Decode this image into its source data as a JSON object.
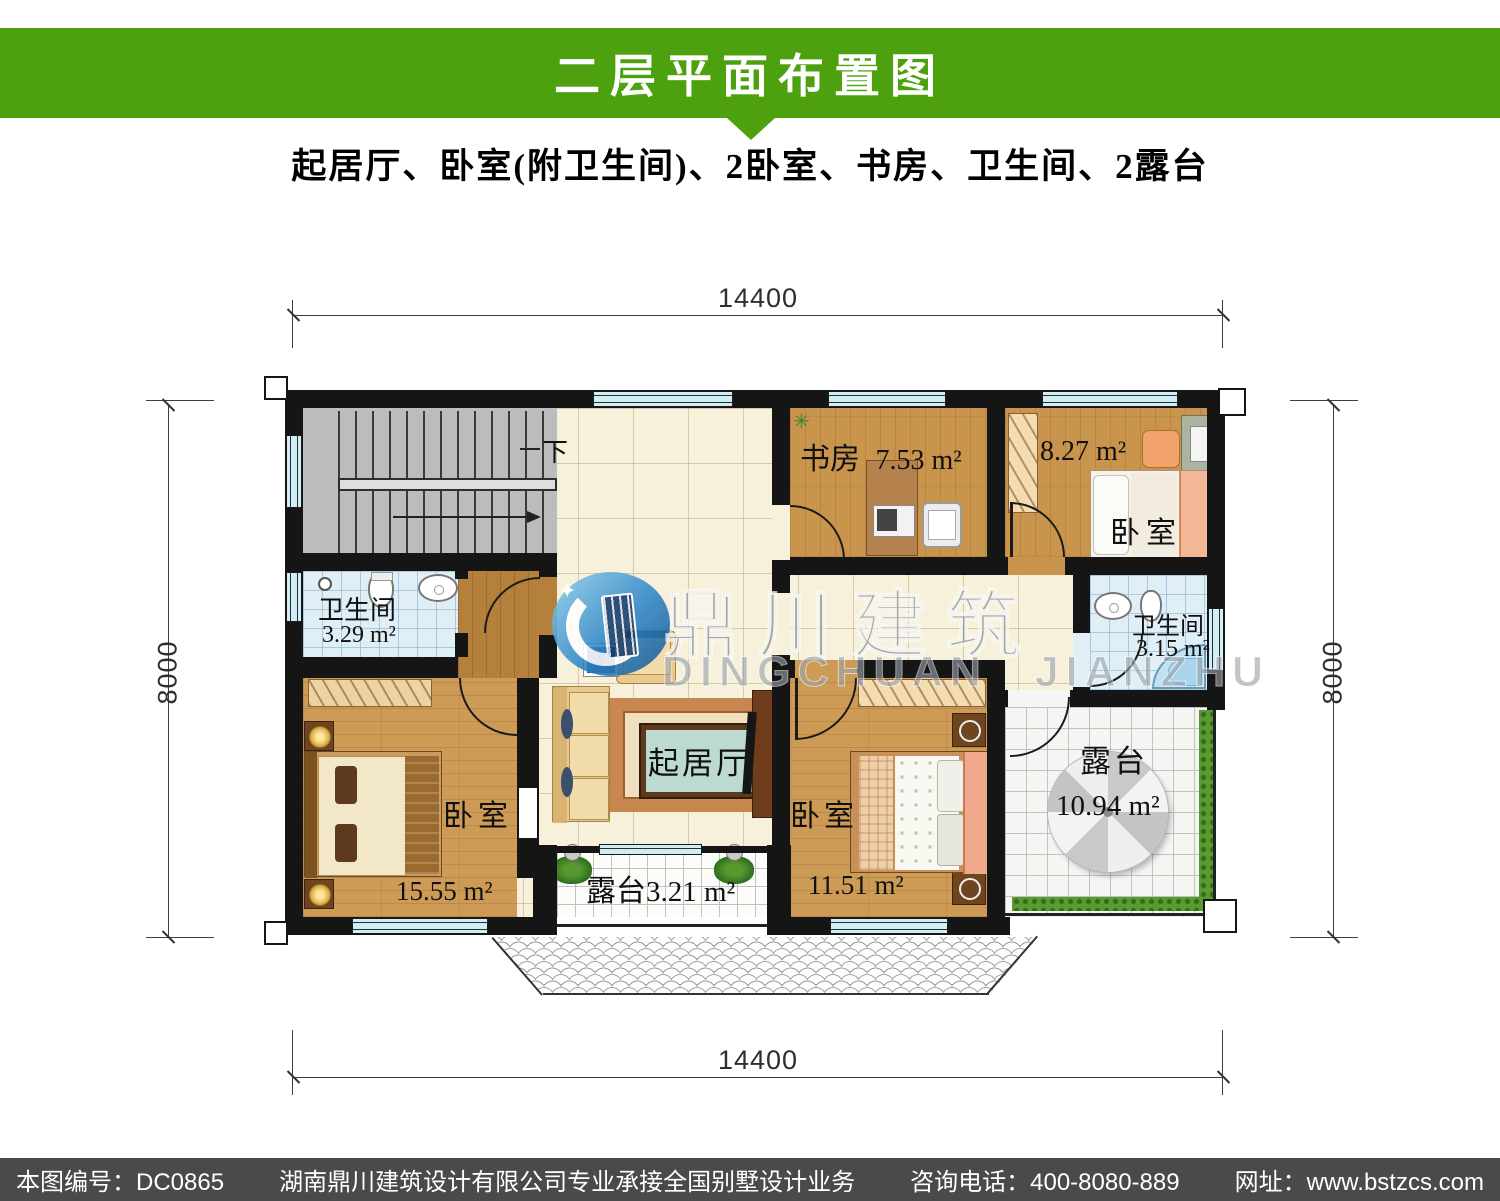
{
  "header": {
    "title": "二层平面布置图",
    "subtitle": "起居厅、卧室(附卫生间)、2卧室、书房、卫生间、2露台",
    "bar_color": "#4da10e"
  },
  "dimensions": {
    "top": "14400",
    "bottom": "14400",
    "left": "8000",
    "right": "8000"
  },
  "stairs": {
    "down_label": "下"
  },
  "rooms": {
    "study": {
      "name": "书房",
      "area": "7.53 m²"
    },
    "bedroom_top_right": {
      "name": "卧室",
      "area": "8.27 m²"
    },
    "bath_left": {
      "name": "卫生间",
      "area": "3.29 m²"
    },
    "bath_right": {
      "name": "卫生间",
      "area": "3.15 m²"
    },
    "bedroom_left": {
      "name": "卧室",
      "area": "15.55 m²"
    },
    "bedroom_bottom": {
      "name": "卧室",
      "area": "11.51 m²"
    },
    "living": {
      "name": "起居厅"
    },
    "terrace_small": {
      "name": "露台",
      "area": "3.21 m²"
    },
    "terrace_large": {
      "name": "露台",
      "area": "10.94 m²"
    }
  },
  "watermark": {
    "cn": "鼎川建筑",
    "en": "DINGCHUAN JIANZHU"
  },
  "footer": {
    "id_text": "本图编号：DC0865",
    "company_text": "湖南鼎川建筑设计有限公司专业承接全国别墅设计业务",
    "phone_text": "咨询电话：400-8080-889",
    "site_text": "网址：www.bstzcs.com"
  }
}
